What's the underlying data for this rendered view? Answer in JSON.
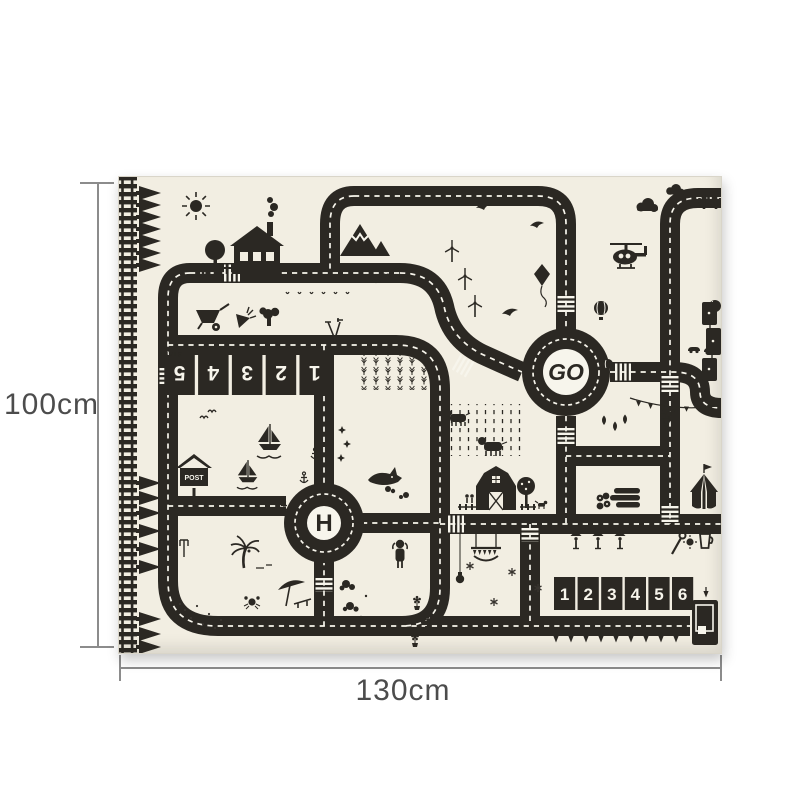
{
  "dimensions": {
    "height_label": "100cm",
    "width_label": "130cm"
  },
  "mat": {
    "roundabout_label": "GO",
    "helipad_label": "H",
    "post_box_label": "POST",
    "start_label": "START",
    "parking_numbers_top": [
      "1",
      "2",
      "3",
      "4",
      "5"
    ],
    "parking_numbers_bottom": [
      "1",
      "2",
      "3",
      "4",
      "5",
      "6"
    ],
    "colors": {
      "mat_background": "#f2eee2",
      "road_ink": "#2b2823",
      "road_marking": "#ffffff",
      "page_background": "#ffffff",
      "dimension_line": "#8c8c8c",
      "dimension_text": "#4c4c4c"
    }
  },
  "icons": [
    "railroad-track",
    "pine-tree",
    "sun",
    "round-tree",
    "picket-fence",
    "house",
    "chimney-smoke",
    "mountain",
    "bird",
    "wind-turbine",
    "kite",
    "helicopter",
    "cloud",
    "cactus",
    "hot-air-balloon",
    "wheat-field",
    "rain-grass",
    "cow",
    "wheelbarrow",
    "carrot",
    "broccoli",
    "garden-tools",
    "sprouts",
    "post-box",
    "sailboat",
    "anchor",
    "star",
    "shark",
    "bush",
    "kid",
    "palm-tree",
    "beach-umbrella",
    "crab",
    "footprints",
    "fork",
    "barn",
    "farmers",
    "dog",
    "apple-tree",
    "log-pile",
    "circus-tent",
    "pennant-banner",
    "balloon-cluster",
    "teardrop-balloon",
    "trapeze",
    "hanging-lamp",
    "snowflake",
    "flower-pot",
    "street-lamp",
    "wrench",
    "gear",
    "cup",
    "container-box",
    "down-arrow-tree",
    "car",
    "train-wagons",
    "crosswalk"
  ]
}
